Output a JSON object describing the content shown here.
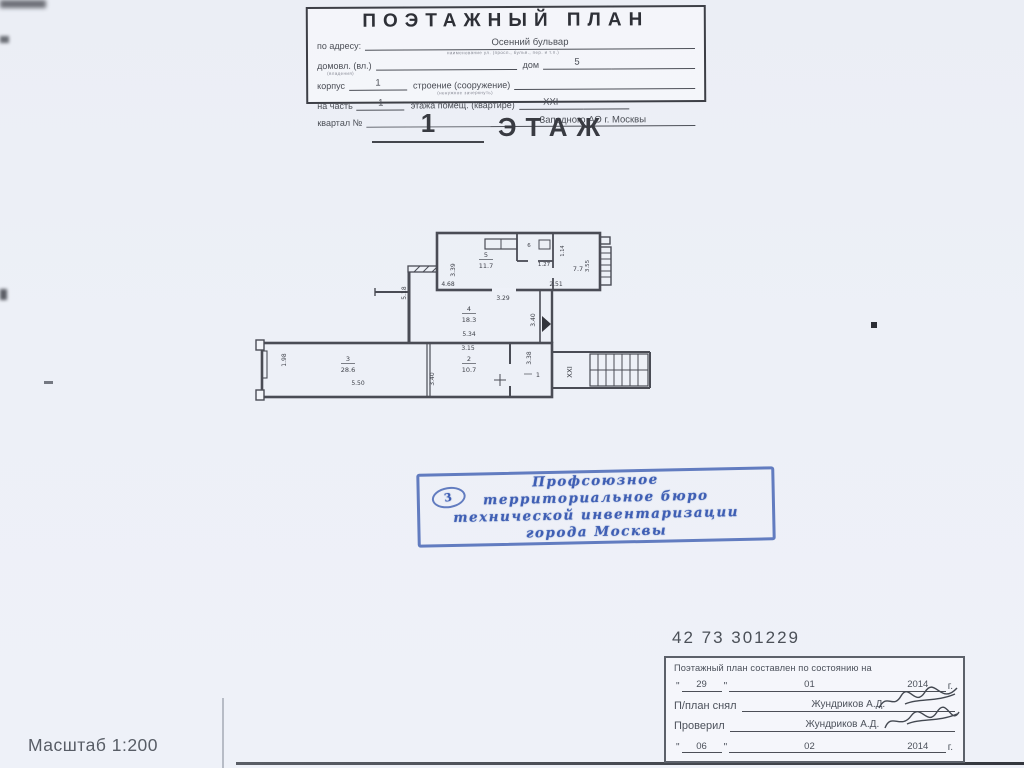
{
  "header_form": {
    "title": "ПОЭТАЖНЫЙ ПЛАН",
    "address_label": "по адресу:",
    "address_value": "Осенний бульвар",
    "address_caption": "наименование ул. (просп., бульв., пер. и т.п.)",
    "domovl_label": "домовл. (вл.)",
    "domovl_caption": "(владения)",
    "dom_label": "дом",
    "dom_value": "5",
    "korpus_label": "корпус",
    "korpus_value": "1",
    "stroenie_label": "строение (сооружение)",
    "stroenie_caption": "(ненужное зачеркнуть)",
    "na_chast_label": "на часть",
    "na_chast_value": "1",
    "etazha_label": "этажа помещ. (квартире)",
    "etazha_value": "XXI",
    "kvartal_label": "квартал №",
    "okrug_value": "Западного   АО г. Москвы"
  },
  "floor_heading": {
    "number": "1",
    "word": "ЭТАЖ"
  },
  "plan": {
    "labels": {
      "room5_num": "5",
      "room5_area": "11.7",
      "dim_339": "3.39",
      "dim_468": "4.68",
      "dim_329": "3.29",
      "dim_251": "2.51",
      "dim_518": "5.18",
      "room6_num": "6",
      "dim_127": "1.27",
      "dim_114": "1.14",
      "room7_area": "7.7",
      "dim_355": "3.55",
      "room4_num": "4",
      "room4_area": "18.3",
      "dim_534": "5.34",
      "dim_315": "3.15",
      "dim_340_hall": "3.40",
      "room3_num": "3",
      "room3_area": "28.6",
      "dim_550": "5.50",
      "dim_198": "1.98",
      "room2_num": "2",
      "room2_area": "10.7",
      "dim_340_room2": "3.40",
      "dim_338": "3.38",
      "part_num": "1",
      "apartment": "XXI"
    }
  },
  "stamp": {
    "number": "3",
    "line1": "Профсоюзное",
    "line2": "территориальное бюро",
    "line3": "технической инвентаризации",
    "line4": "города Москвы",
    "color": "#3f5fb4"
  },
  "plan_number": "42 73 301229",
  "footer_form": {
    "line1": "Поэтажный план составлен по состоянию на",
    "quote": "\"",
    "date1_day": "29",
    "date1_month": "01",
    "date1_year": "2014",
    "year_suffix": "г.",
    "snyal_label": "П/план снял",
    "snyal_value": "Жундриков А.Д.",
    "proveril_label": "Проверил",
    "proveril_value": "Жундриков А.Д.",
    "date2_day": "06",
    "date2_month": "02",
    "date2_year": "2014"
  },
  "scale_label": "Масштаб 1:200"
}
